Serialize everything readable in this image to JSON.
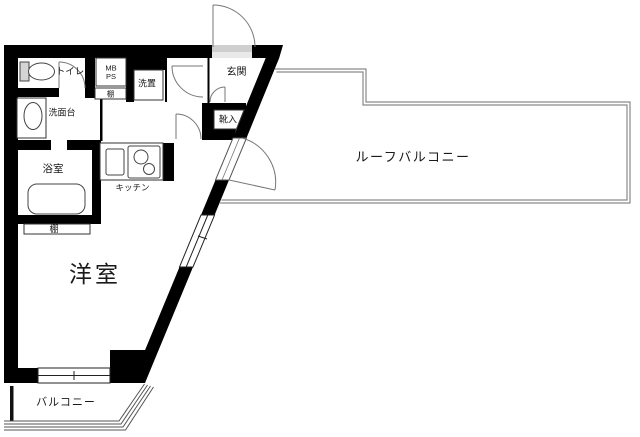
{
  "floorplan": {
    "labels": {
      "toilet": "トイレ",
      "mb": "MB",
      "ps": "PS",
      "shelf_top": "棚",
      "laundry": "洗置",
      "washstand": "洗面台",
      "bathroom": "浴室",
      "kitchen": "キッチン",
      "entrance": "玄関",
      "shoe_box": "靴入",
      "western_room": "洋室",
      "shelf_bottom": "棚",
      "roof_balcony": "ルーフバルコニー",
      "balcony": "バルコニー"
    },
    "colors": {
      "wall": "#000000",
      "thin_line": "#333333",
      "roof_balcony_outline": "#8a8a8a",
      "background": "#ffffff"
    }
  }
}
